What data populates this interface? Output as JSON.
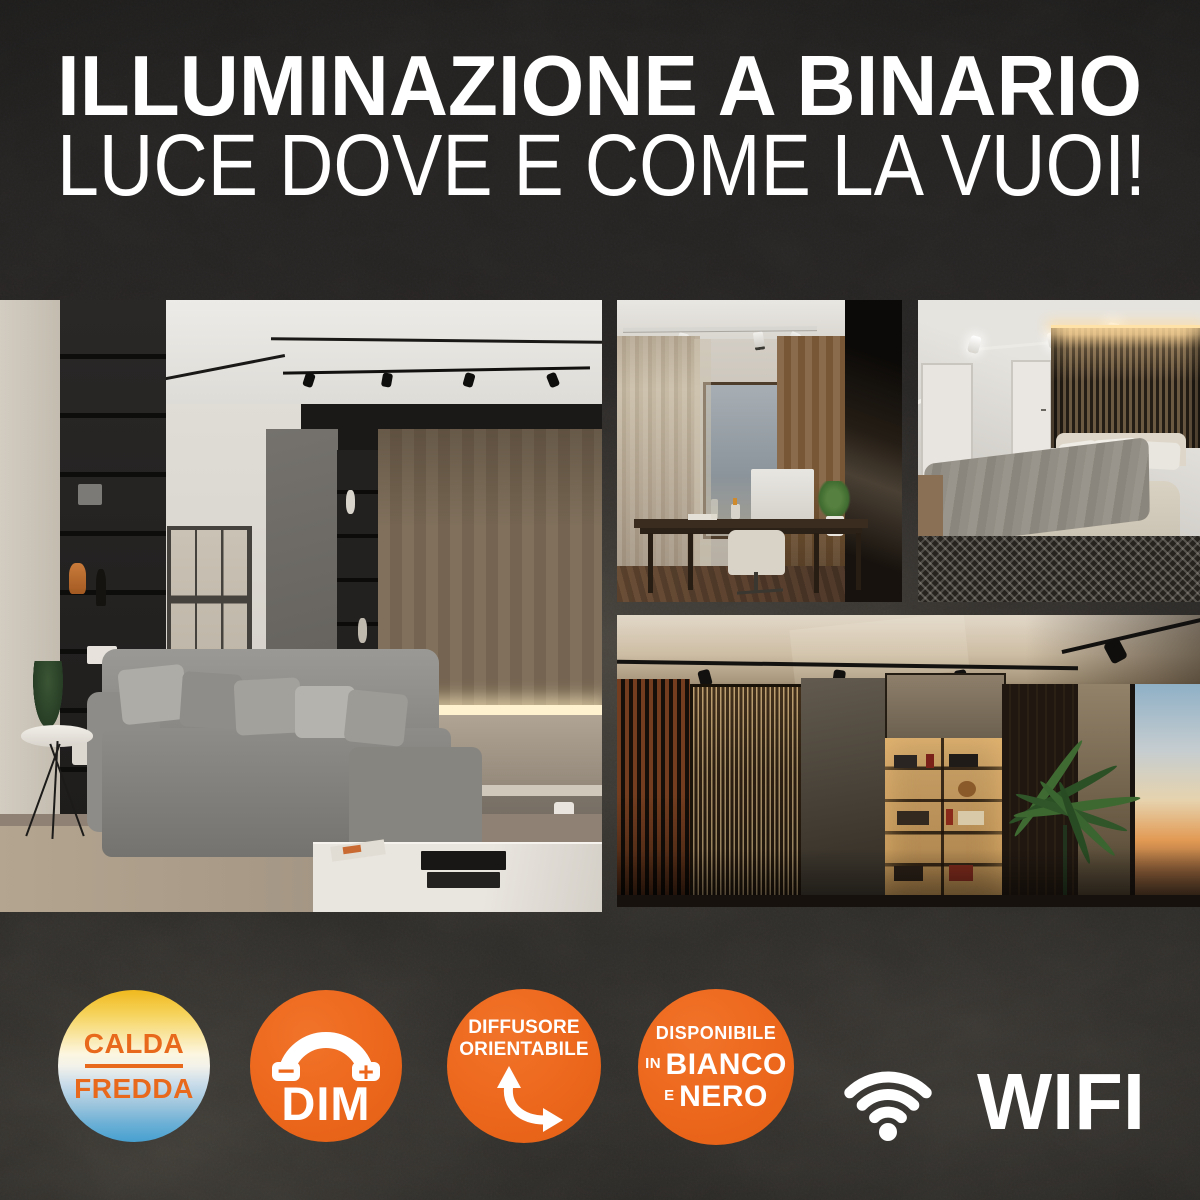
{
  "header": {
    "line1": "ILLUMINAZIONE A BINARIO",
    "line2": "LUCE DOVE E COME LA VUOI!"
  },
  "badges": {
    "cct": {
      "warm": "CALDA",
      "cold": "FREDDA",
      "text_color": "#e8681c",
      "gradient_top": "#f0b91e",
      "gradient_mid": "#fdf6e3",
      "gradient_bottom": "#47a0d0"
    },
    "dim": {
      "minus": "−",
      "plus": "+",
      "label": "DIM"
    },
    "orientable": {
      "line1": "DIFFUSORE",
      "line2": "ORIENTABILE"
    },
    "variants": {
      "line1": "DISPONIBILE",
      "small2": "IN",
      "big2": "BIANCO",
      "small3": "E",
      "big3": "NERO"
    },
    "wifi": {
      "label": "WIFI"
    }
  },
  "colors": {
    "background": "#262423",
    "accent_orange": "#ec671c",
    "text_white": "#ffffff"
  },
  "icons": {
    "dim": "dimmer-arc-icon",
    "orientable": "curved-double-arrow-icon",
    "wifi": "wifi-icon"
  }
}
